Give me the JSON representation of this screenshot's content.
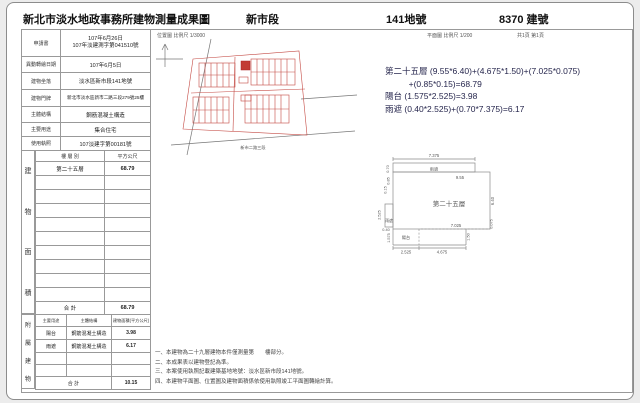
{
  "header": {
    "title": "新北市淡水地政事務所建物測量成果圖",
    "section": "新市段",
    "land_no": "141地號",
    "building_no": "8370 建號"
  },
  "scales": {
    "location": "位置圖 比例尺 1/3000",
    "plan": "平面圖 比例尺 1/200",
    "page": "共1頁 第1頁"
  },
  "info_table": {
    "rows": [
      {
        "label": "申請書",
        "value": "107年6月26日",
        "value2": "107年淡建測字第041510號"
      },
      {
        "label": "異動轉繪日期",
        "value": "107年6月5日"
      },
      {
        "label": "建物坐落",
        "value": "淡水區新市段141地號"
      },
      {
        "label": "建物門牌",
        "value": "新北市淡水區新市二路三段279號25樓"
      },
      {
        "label": "主體結構",
        "value": "鋼筋混凝土構造"
      },
      {
        "label": "主要用途",
        "value": "集合住宅"
      },
      {
        "label": "使用執照",
        "value": "107淡建字第00181號"
      }
    ]
  },
  "area_table": {
    "side_label": "建物面積",
    "col_floor": "樓 層 別",
    "col_area": "平方公尺",
    "floor": "第二十五層",
    "area": "68.79",
    "total_label": "合  計",
    "total": "68.79"
  },
  "annex_table": {
    "side_label": "附屬建物",
    "col_use": "主要用途",
    "col_structure": "主體結構",
    "col_area": "建物面積(平方公尺)",
    "rows": [
      {
        "use": "陽台",
        "structure": "鋼筋混凝土構造",
        "area": "3.98"
      },
      {
        "use": "雨遮",
        "structure": "鋼筋混凝土構造",
        "area": "6.17"
      }
    ],
    "total_label": "合  計",
    "total": "10.15"
  },
  "calc": {
    "lines": [
      "第二十五層 (9.55*6.40)+(4.675*1.50)+(7.025*0.075)",
      "          +(0.85*0.15)=68.79",
      "陽台 (1.575*2.525)=3.98",
      "雨遮 (0.40*2.525)+(0.70*7.375)=6.17"
    ]
  },
  "floor_plan": {
    "room": "第二十五層",
    "canopy_top": "雨遮",
    "canopy_left": "雨遮",
    "balcony": "陽台",
    "dims": {
      "top_w": "7.375",
      "top_h": "0.70",
      "inner_w": "9.55",
      "left_a": "0.85",
      "left_b": "0.15",
      "right_h": "6.40",
      "right_step": "0.075",
      "canopy_left_h": "2.525",
      "balcony_offset": "0.40",
      "balcony_h": "1.575",
      "balcony_w": "2.525",
      "bottom_w": "4.675",
      "bottom_h": "1.50",
      "lower_w": "7.025"
    }
  },
  "location_map": {
    "street": "新市二路三段"
  },
  "notes": [
    "一、本建物為二十九層建物本件僅測量第　　樓部分。",
    "二、本成果表以建物登記為準。",
    "三、本案使用執照記載建築基地地號：淡水區新市段141地號。",
    "四、本建物平面圖、位置圖及建物面積係依使用執照竣工平面圖轉繪計算。"
  ]
}
